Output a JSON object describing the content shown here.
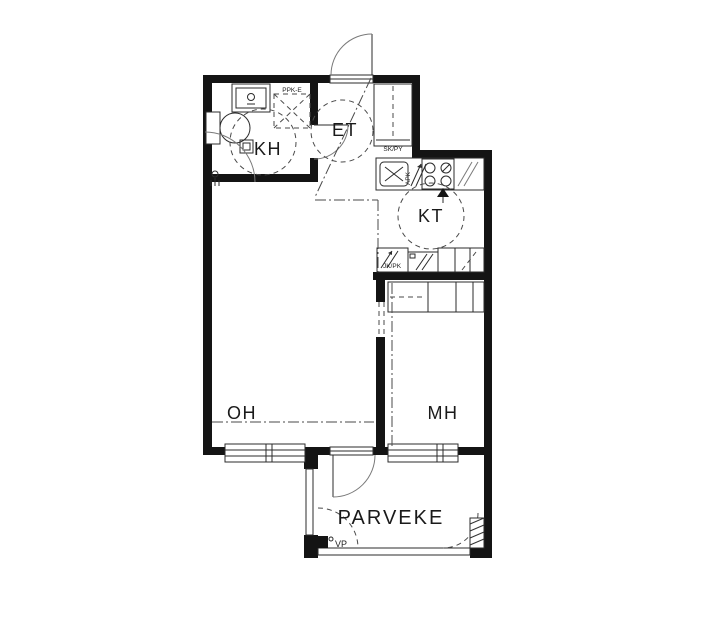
{
  "plan": {
    "rooms": [
      {
        "key": "kh",
        "label": "KH"
      },
      {
        "key": "et",
        "label": "ET"
      },
      {
        "key": "kt",
        "label": "KT"
      },
      {
        "key": "oh",
        "label": "OH"
      },
      {
        "key": "mh",
        "label": "MH"
      },
      {
        "key": "parveke",
        "label": "PARVEKE"
      }
    ],
    "annotations": [
      {
        "key": "washer-reservation",
        "label": "PPK-E"
      },
      {
        "key": "closet",
        "label": "SK/PY"
      },
      {
        "key": "fridge-freezer",
        "label": "JK/PK"
      },
      {
        "key": "dishwasher-reservation",
        "label": "APK"
      },
      {
        "key": "water-point",
        "label": "VP"
      }
    ],
    "colors": {
      "background": "#ffffff",
      "wall": "#141414",
      "line": "#2b2b2b",
      "dashed": "#4a4a4a"
    }
  }
}
